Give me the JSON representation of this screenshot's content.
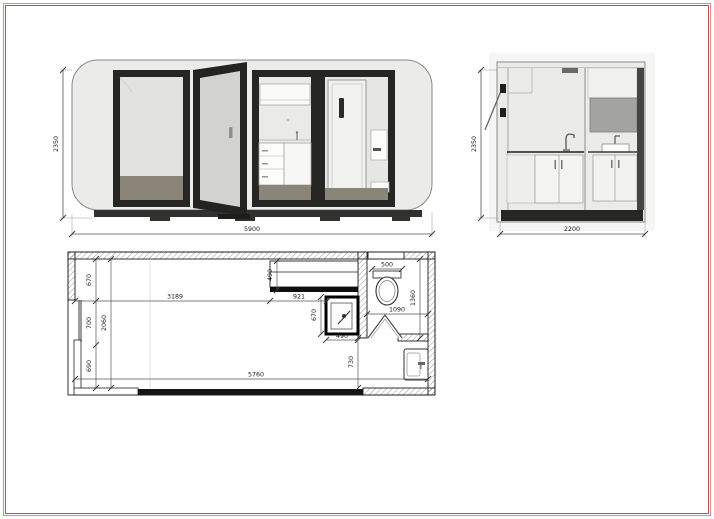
{
  "sheet": {
    "type_label": "modular-pod-drawing",
    "colors": {
      "frame_red": "#b7514f",
      "frame_pink": "#d98b89",
      "pod_body_gray": "#ebebe9",
      "door_frame_dark": "#262624",
      "floor_brown": "#8b8478",
      "wall_black": "#1c1c1c"
    }
  },
  "front_elevation": {
    "height_mm": "2350",
    "length_mm": "5900"
  },
  "side_elevation": {
    "height_mm": "2350",
    "depth_mm": "2200"
  },
  "floor_plan": {
    "interior_length": "5760",
    "interior_depth": "2060",
    "zone_top_depth": "670",
    "zone_mid_depth": "700",
    "zone_bottom_depth": "690",
    "living_length": "3189",
    "kitchen_length": "921",
    "counter_depth": "490",
    "sink_unit_depth": "670",
    "sink_unit_width": "490",
    "toilet_width": "500",
    "bathroom_width": "1090",
    "bathroom_depth": "1360",
    "entry_depth": "730"
  }
}
